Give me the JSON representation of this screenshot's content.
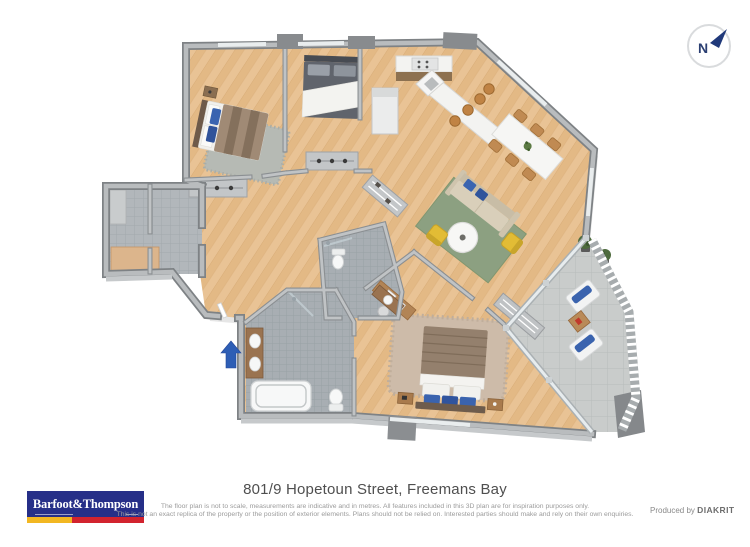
{
  "compass": {
    "label": "N",
    "arrow_color": "#20397a"
  },
  "entry_arrow": {
    "direction": "up",
    "color": "#2e5eb5"
  },
  "floorplan_colors": {
    "wood_floor": "#e9c395",
    "wall_gray": "#7e8285",
    "wall_top": "#b9bcbe",
    "bathroom_tile": "#a8aeb3",
    "balcony_tile": "#c9cccb",
    "rug_green": "#8ca081",
    "accent_blue": "#3a63ae",
    "accent_yellow": "#e2bc35",
    "bed_brown": "#94806d"
  },
  "footer": {
    "logo": {
      "text": "Barfoot&Thompson",
      "background": "#262f88",
      "stripe_yellow": "#f2b722",
      "stripe_red": "#d2232e"
    },
    "title": "801/9 Hopetoun Street, Freemans Bay",
    "disclaimer_line1": "The floor plan is not to scale, measurements are indicative and in metres. All features included in this 3D plan are for inspiration purposes only.",
    "disclaimer_line2": "This is not an exact replica of the property or the position of exterior elements. Plans should not be relied on. Interested parties should make and rely on their own enquiries.",
    "produced_by": "Produced by",
    "producer": "DIAKRIT"
  }
}
